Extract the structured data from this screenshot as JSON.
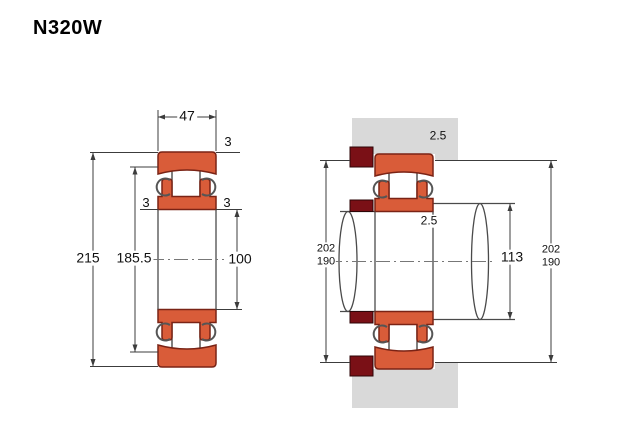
{
  "title": "N320W",
  "colors": {
    "ring_fill": "#d95c39",
    "ring_outline": "#7a2315",
    "abutment_fill": "#7a1016",
    "housing_fill": "#d9d9d9",
    "line": "#3c3c3c"
  },
  "left_view": {
    "dims": {
      "width": "47",
      "outer_ring_chamfer": "3",
      "inner_ring_chamfer_left": "3",
      "inner_ring_chamfer_right": "3",
      "outer_diameter": "215",
      "raceway_diameter": "185.5",
      "bore_diameter": "100"
    }
  },
  "right_view": {
    "dims": {
      "housing_fillet_radius": "2.5",
      "shaft_fillet_radius": "2.5",
      "left_abutment": {
        "max": "202",
        "min": "190"
      },
      "shaft_abutment_diameter": "113",
      "right_abutment": {
        "max": "202",
        "min": "190"
      }
    }
  }
}
